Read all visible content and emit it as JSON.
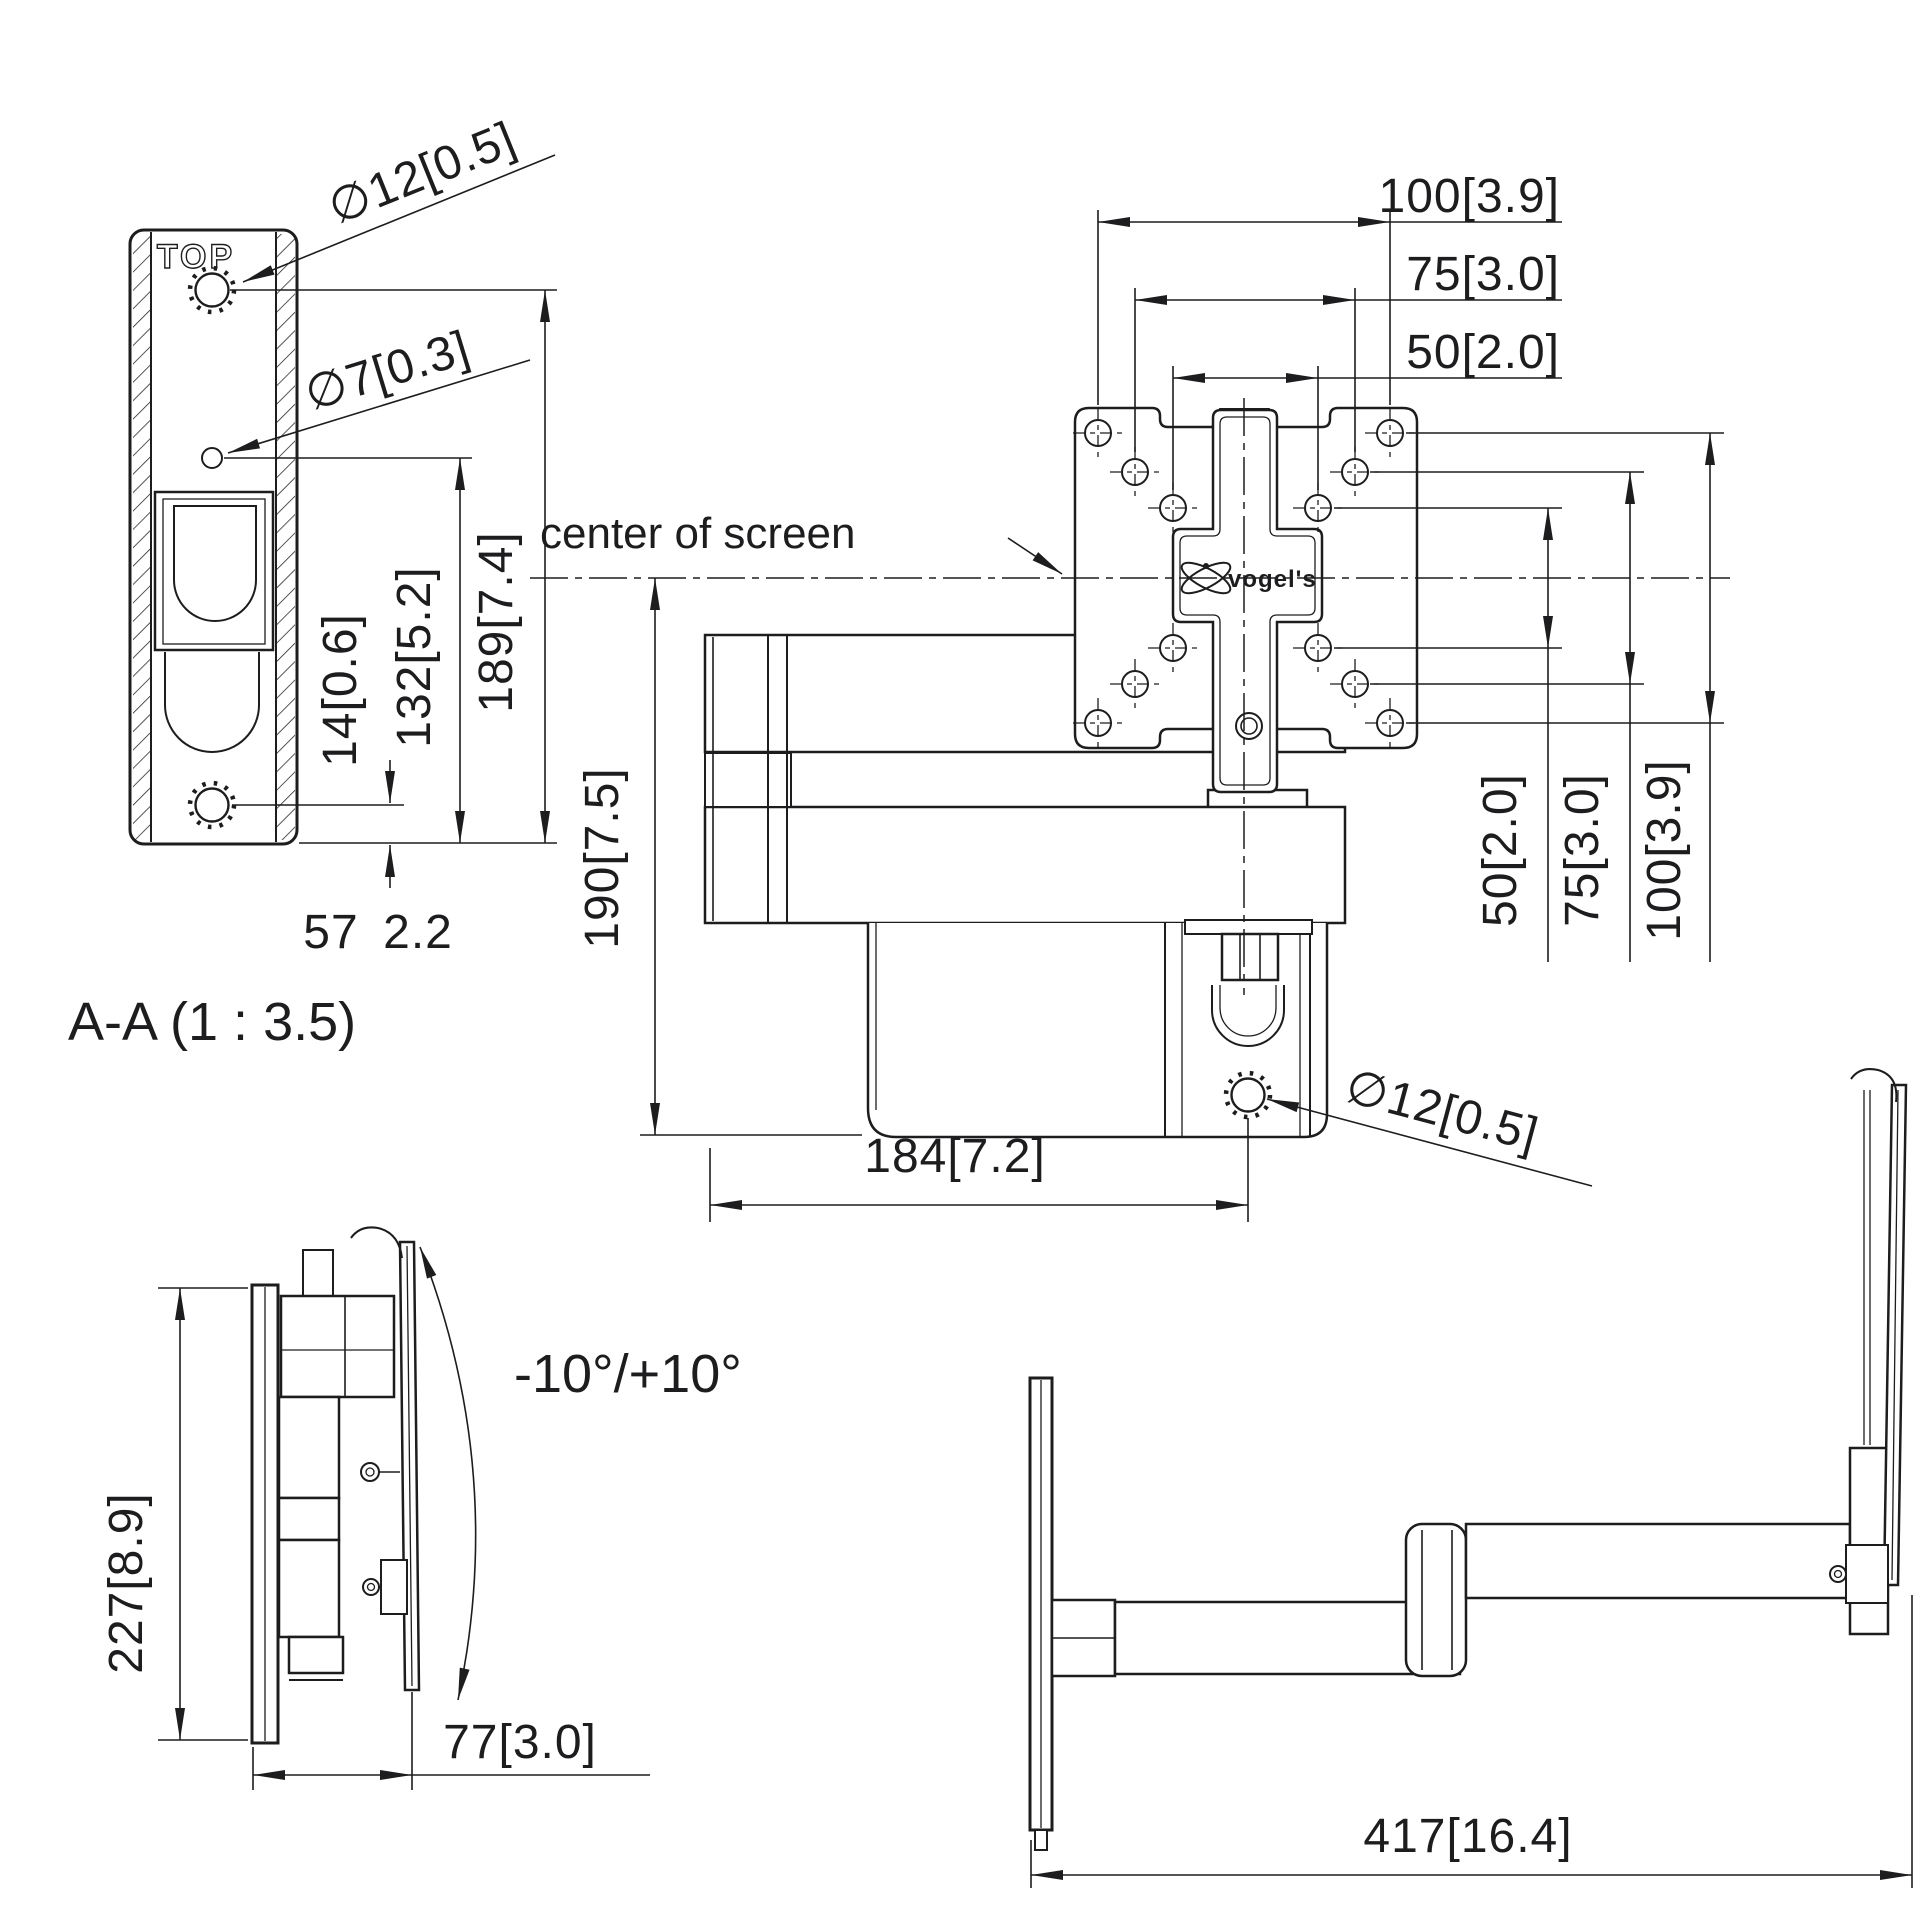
{
  "section_view": {
    "title": "A-A (1 : 3.5)",
    "plate_marking": "TOP",
    "dia_top_hole": "∅12[0.5]",
    "dia_pilot_hole": "∅7[0.3]",
    "dim_total_height": "189[7.4]",
    "dim_hole_height": "132[5.2]",
    "dim_bottom_offset": "14[0.6]",
    "dim_width_mm": "57",
    "dim_width_in": "2.2"
  },
  "front_view": {
    "center_label": "center of screen",
    "brand": "vogel's",
    "dim_vesa_h": [
      "100[3.9]",
      "75[3.0]",
      "50[2.0]"
    ],
    "dim_vesa_v": [
      "50[2.0]",
      "75[3.0]",
      "100[3.9]"
    ],
    "dim_height": "190[7.5]",
    "dim_arm": "184[7.2]",
    "dia_wall_hole": "∅12[0.5]"
  },
  "side_view_folded": {
    "dim_height": "227[8.9]",
    "dim_depth": "77[3.0]",
    "tilt_range": "-10°/+10°"
  },
  "side_view_extended": {
    "dim_reach": "417[16.4]"
  }
}
